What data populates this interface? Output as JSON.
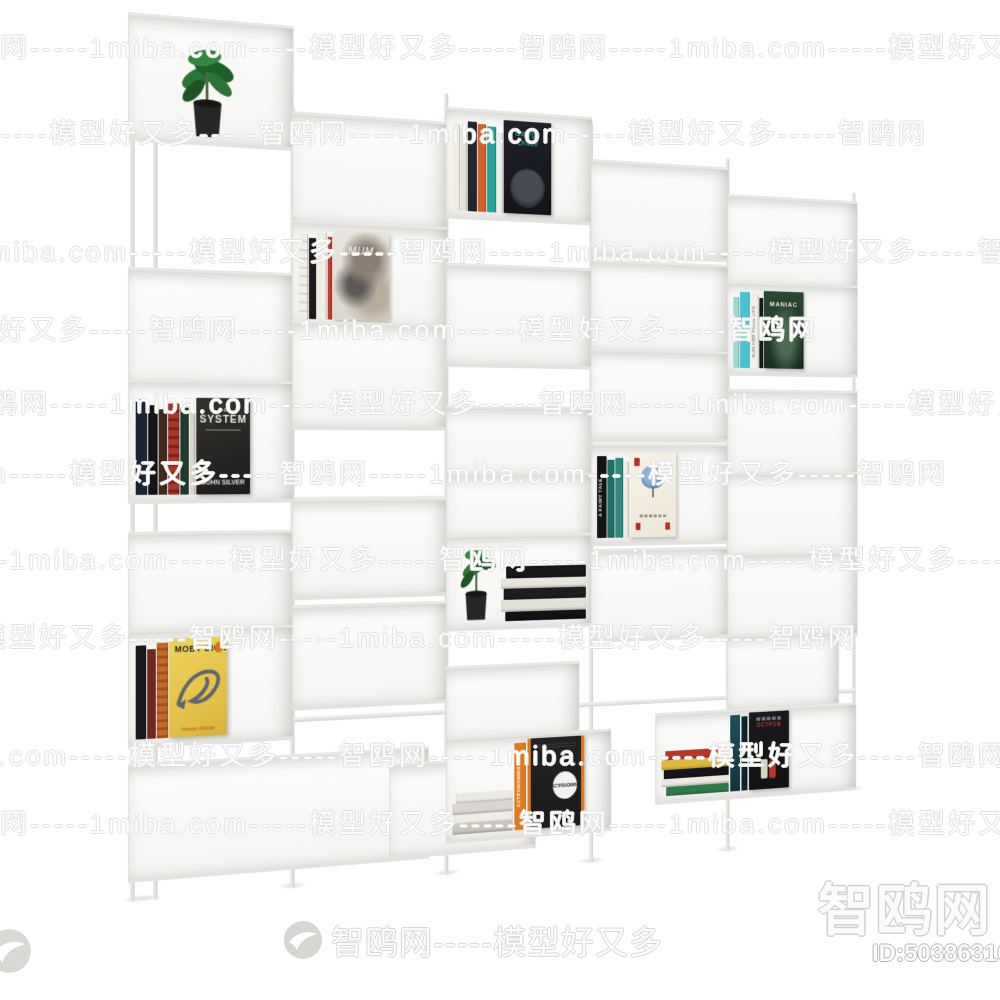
{
  "watermark": {
    "chain": "智鸥网-----1miba.com-----模型好又多-----智鸥网-----1miba.com-----模型好又多-----智鸥网",
    "site_cn": "智鸥网",
    "site_en": "1miba.com",
    "tagline": "模型好又多",
    "banner_text": "智鸥网-----模型好又多",
    "corner_text": "智鸥网",
    "id_text": "ID:503863106",
    "logo_icon": "bird-swoosh-circle"
  },
  "books": {
    "system": {
      "title_top": "THE",
      "title": "SYSTEM",
      "author": "JOHN SILVER"
    },
    "moby": {
      "title": "MOBY DICK",
      "author": "Herman Melville",
      "publisher_icon": "penguin-logo"
    },
    "orwell": {
      "title": "George Orwell"
    },
    "mum": {
      "title": "MUM"
    },
    "maniac": {
      "title": "MANIAC"
    },
    "run_spine": {
      "title": "RUN FOR YOUR LIFE"
    },
    "fairy": {
      "spine_title": "A FAIRY TALE"
    },
    "astro": {
      "title": "АСТРОНОМИЯ"
    },
    "ostrov": {
      "title": "ОСТРОВ"
    }
  },
  "colors": {
    "shelf_white": "#f5f4f2",
    "shelf_edge": "#deddd9",
    "moby_yellow": "#e5c64c",
    "astro_orange": "#e07a1f",
    "orwell_teal": "#3ec2b3",
    "maniac_green": "#24392c",
    "cyan_spine": "#49c3d4",
    "red_accent": "#b8352a",
    "pot_black": "#262626",
    "leaf_green": "#2f7d38"
  },
  "scene": {
    "subject": "white modular staggered metal bookshelf with books and potted plants"
  }
}
